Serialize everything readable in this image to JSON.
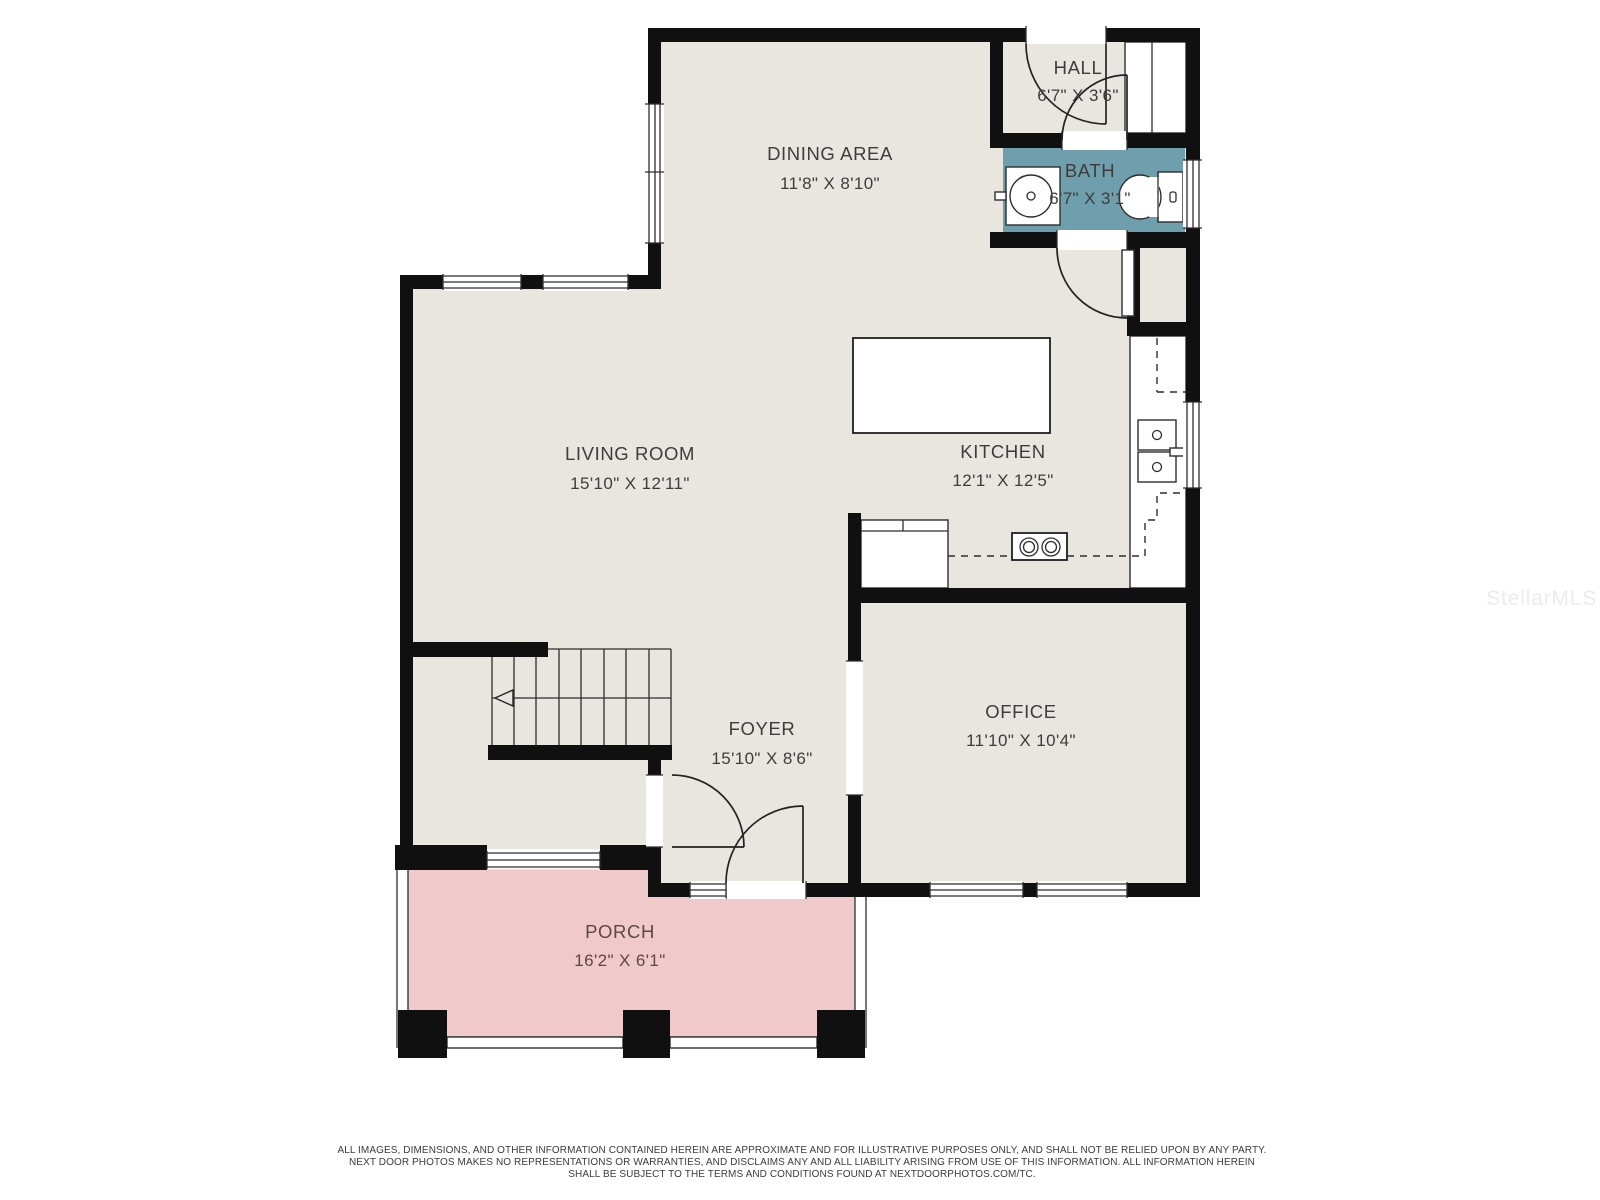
{
  "colors": {
    "wall": "#101010",
    "floor": "#e9e6df",
    "bath_floor": "#6f9fad",
    "porch_floor": "#f0c9ca",
    "label_text": "#3d3d3d",
    "porch_text": "#5c4848",
    "watermark_text": "#ececec"
  },
  "rooms": {
    "dining": {
      "name": "DINING AREA",
      "dims": "11'8\" X 8'10\""
    },
    "hall": {
      "name": "HALL",
      "dims": "6'7\" X 3'6\""
    },
    "bath": {
      "name": "BATH",
      "dims": "6'7\" X 3'1\""
    },
    "living": {
      "name": "LIVING ROOM",
      "dims": "15'10\" X 12'11\""
    },
    "kitchen": {
      "name": "KITCHEN",
      "dims": "12'1\" X 12'5\""
    },
    "foyer": {
      "name": "FOYER",
      "dims": "15'10\" X 8'6\""
    },
    "office": {
      "name": "OFFICE",
      "dims": "11'10\" X 10'4\""
    },
    "porch": {
      "name": "PORCH",
      "dims": "16'2\" X 6'1\""
    }
  },
  "watermark": "StellarMLS",
  "disclaimer": {
    "line1": "ALL IMAGES, DIMENSIONS, AND OTHER INFORMATION CONTAINED HEREIN ARE APPROXIMATE AND FOR ILLUSTRATIVE PURPOSES ONLY, AND SHALL NOT BE RELIED UPON BY ANY PARTY.",
    "line2": "NEXT DOOR PHOTOS MAKES NO REPRESENTATIONS OR WARRANTIES, AND DISCLAIMS ANY AND ALL LIABILITY ARISING FROM USE OF THIS INFORMATION. ALL INFORMATION HEREIN",
    "line3": "SHALL BE SUBJECT TO THE TERMS AND CONDITIONS FOUND AT NEXTDOORPHOTOS.COM/TC."
  }
}
